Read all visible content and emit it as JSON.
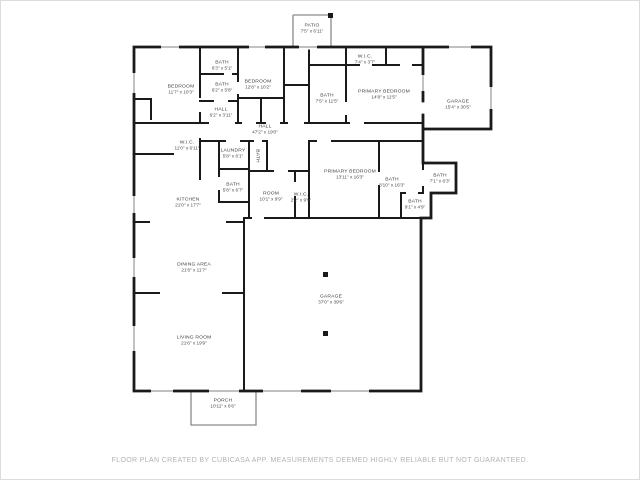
{
  "page": {
    "background": "#ffffff",
    "frame_border": "#dcdcdc"
  },
  "floorplan": {
    "colors": {
      "wall": "#1a1a1a",
      "thin_outline": "#8a8a8a",
      "window_line": "#9a9a9a",
      "label_text": "#3d3d3d",
      "footer_text": "#b3b3b3"
    },
    "rooms": [
      {
        "name": "PATIO",
        "dims": "7'5\" x 6'11\""
      },
      {
        "name": "BEDROOM",
        "dims": "11'7\" x 10'3\""
      },
      {
        "name": "BATH",
        "dims": "6'3\" x 5'1\""
      },
      {
        "name": "BATH",
        "dims": "6'2\" x 5'8\""
      },
      {
        "name": "BEDROOM",
        "dims": "12'8\" x 10'2\""
      },
      {
        "name": "HALL",
        "dims": "6'2\" x 3'11\""
      },
      {
        "name": "W.I.C.",
        "dims": "7'4\" x 3'7\""
      },
      {
        "name": "BATH",
        "dims": "7'5\" x 11'5\""
      },
      {
        "name": "PRIMARY BEDROOM",
        "dims": "14'8\" x 11'5\""
      },
      {
        "name": "GARAGE",
        "dims": "15'4\" x 30'5\""
      },
      {
        "name": "HALL",
        "dims": "47'2\" x 19'0\""
      },
      {
        "name": "W.I.C.",
        "dims": "11'0\" x 6'11\""
      },
      {
        "name": "LAUNDRY",
        "dims": "5'8\" x 6'1\""
      },
      {
        "name": "BATH",
        "dims": ""
      },
      {
        "name": "BATH",
        "dims": "5'8\" x 6'7\""
      },
      {
        "name": "ROOM",
        "dims": "10'1\" x 9'9\""
      },
      {
        "name": "W.I.C.",
        "dims": "2'2\" x 9'9\""
      },
      {
        "name": "PRIMARY BEDROOM",
        "dims": "13'11\" x 16'3\""
      },
      {
        "name": "BATH",
        "dims": "8'10\" x 16'3\""
      },
      {
        "name": "BATH",
        "dims": "7'1\" x 6'3\""
      },
      {
        "name": "BATH",
        "dims": "9'1\" x 4'9\""
      },
      {
        "name": "KITCHEN",
        "dims": "21'0\" x 17'7\""
      },
      {
        "name": "DINING AREA",
        "dims": "21'6\" x 11'7\""
      },
      {
        "name": "LIVING ROOM",
        "dims": "21'6\" x 19'9\""
      },
      {
        "name": "GARAGE",
        "dims": "37'0\" x 39'6\""
      },
      {
        "name": "PORCH",
        "dims": "10'11\" x 6'6\""
      }
    ],
    "footer": "FLOOR PLAN CREATED BY CUBICASA APP. MEASUREMENTS DEEMED HIGHLY RELIABLE BUT NOT GUARANTEED."
  }
}
